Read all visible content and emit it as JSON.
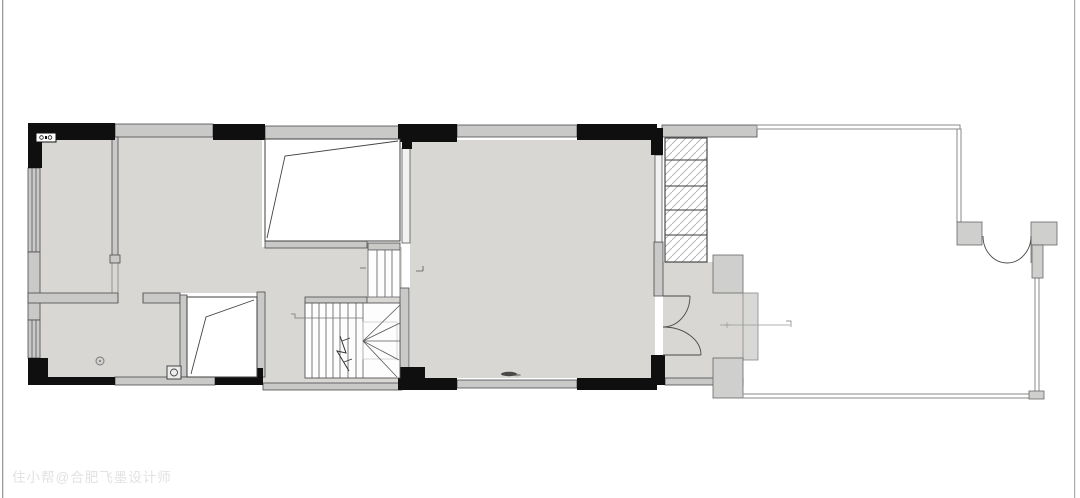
{
  "watermark": {
    "text": "住小帮@合肥飞墨设计师"
  },
  "colors": {
    "floor": "#d8d7d3",
    "wall_fill": "#c9c9c8",
    "wall_dark": "#4a4a4a",
    "black": "#0f0f0f",
    "line": "#5a5a5a",
    "thin_wall": "#8a8a8a",
    "hatch": "#aaaaaa",
    "void_stroke": "#3f3f3f",
    "portal_fill": "#cfcfce",
    "portal_light": "#d8d8d6",
    "watermark": "#e2e2e2",
    "frame_left": "#9a9a9a",
    "frame_right": "#ababab"
  }
}
